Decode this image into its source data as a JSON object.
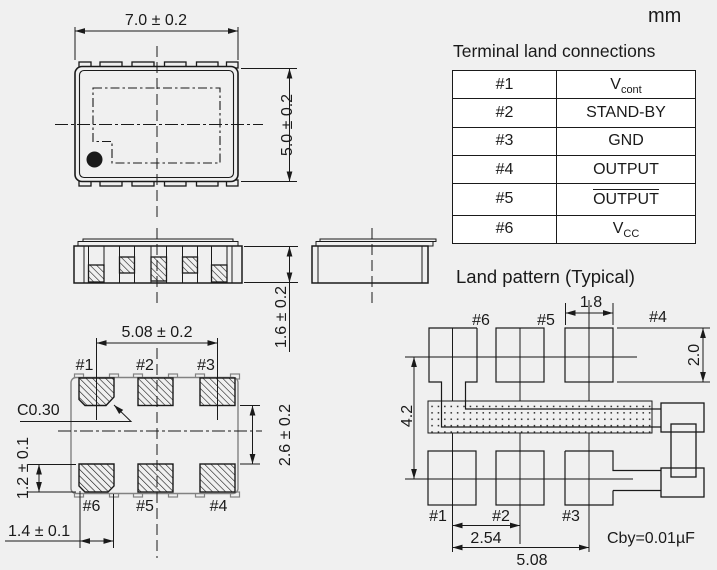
{
  "unit_label": "mm",
  "colors": {
    "background": "#f0f0f0",
    "line": "#1a1a1a",
    "reference_gray": "#828282",
    "table_bg": "#ffffff"
  },
  "terminal_table": {
    "title": "Terminal land connections",
    "rows": [
      {
        "pin": "#1",
        "signal": "V",
        "sub": "cont"
      },
      {
        "pin": "#2",
        "signal": "STAND-BY"
      },
      {
        "pin": "#3",
        "signal": "GND"
      },
      {
        "pin": "#4",
        "signal": "OUTPUT"
      },
      {
        "pin": "#5",
        "signal": "OUTPUT",
        "overline": true
      },
      {
        "pin": "#6",
        "signal": "V",
        "sub": "CC"
      }
    ]
  },
  "top_view": {
    "width_dim": "7.0 ± 0.2",
    "height_dim": "5.0 ± 0.2"
  },
  "side_view": {
    "height_dim": "1.6 ± 0.2"
  },
  "bottom_view": {
    "pad_span_dim": "5.08 ± 0.2",
    "row_gap_dim": "2.6 ± 0.2",
    "pad_height_dim": "1.2 ± 0.1",
    "pad_width_dim": "1.4 ± 0.1",
    "chamfer_label": "C0.30",
    "labels_top": [
      "#1",
      "#2",
      "#3"
    ],
    "labels_bottom": [
      "#6",
      "#5",
      "#4"
    ]
  },
  "land_pattern": {
    "title": "Land pattern (Typical)",
    "labels_top": [
      "#6",
      "#5",
      "#4"
    ],
    "labels_bottom": [
      "#1",
      "#2",
      "#3"
    ],
    "pad_width_dim": "1.8",
    "pad_height_dim": "2.0",
    "row_span_dim": "4.2",
    "pitch_dim": "2.54",
    "span_dim": "5.08",
    "cap_note": "Cby=0.01µF"
  }
}
